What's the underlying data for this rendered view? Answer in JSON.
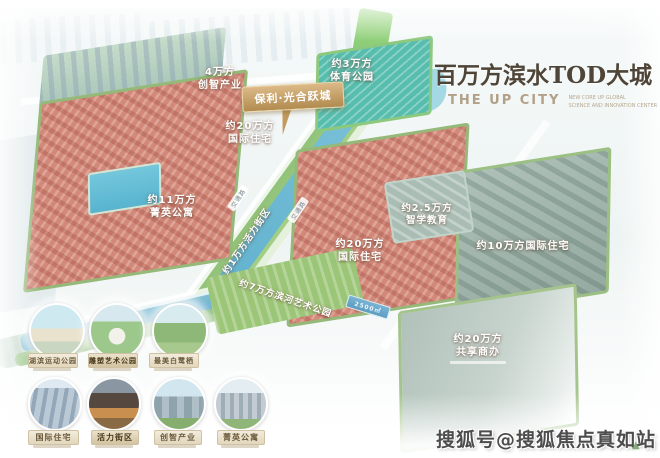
{
  "title": {
    "cn": "百万方滨水TOD大城",
    "en": "THE UP CITY",
    "tagline_line1": "NEW CORE UP GLOBAL",
    "tagline_line2": "SCIENCE AND INNOVATION CENTER"
  },
  "banner": {
    "text": "保利·光合跃城"
  },
  "map": {
    "labels": {
      "chuangzhi": {
        "line1": "4万方",
        "line2": "创智产业"
      },
      "sports": {
        "line1": "约3万方",
        "line2": "体育公园"
      },
      "intl_nw": {
        "line1": "约20万方",
        "line2": "国际住宅"
      },
      "jingying": {
        "line1": "约11万方",
        "line2": "菁英公寓"
      },
      "vitality": {
        "text": "约1万方活力街区"
      },
      "intl_center": {
        "line1": "约20万方",
        "line2": "国际住宅"
      },
      "zhixue": {
        "line1": "约2.5万方",
        "line2": "智学教育"
      },
      "intl_east": {
        "text": "约10万方国际住宅"
      },
      "shared_office": {
        "line1": "约20万方",
        "line2": "共享商办"
      },
      "river_park": {
        "text": "约7万方滨河艺术公园"
      },
      "plaza_sign": {
        "text": "2500㎡"
      },
      "road1": {
        "text": "交通路"
      },
      "road2": {
        "text": "交通路"
      }
    }
  },
  "thumbnails": {
    "row1": [
      {
        "label": "湖滨运动公园"
      },
      {
        "label": "雕塑艺术公园"
      },
      {
        "label": "最美白鹭栖"
      }
    ],
    "row2": [
      {
        "label": "国际住宅"
      },
      {
        "label": "活力街区"
      },
      {
        "label": "创智产业"
      },
      {
        "label": "菁英公寓"
      }
    ]
  },
  "watermark": {
    "text": "搜狐号@搜狐焦点真如站"
  },
  "colors": {
    "accent_gold": "#c2a064",
    "residential_red": "#d2897a",
    "park_green": "#9cc677",
    "water_blue": "#7cc2d9",
    "office_grey": "#9db3a9",
    "title_brown": "#4e4437"
  }
}
